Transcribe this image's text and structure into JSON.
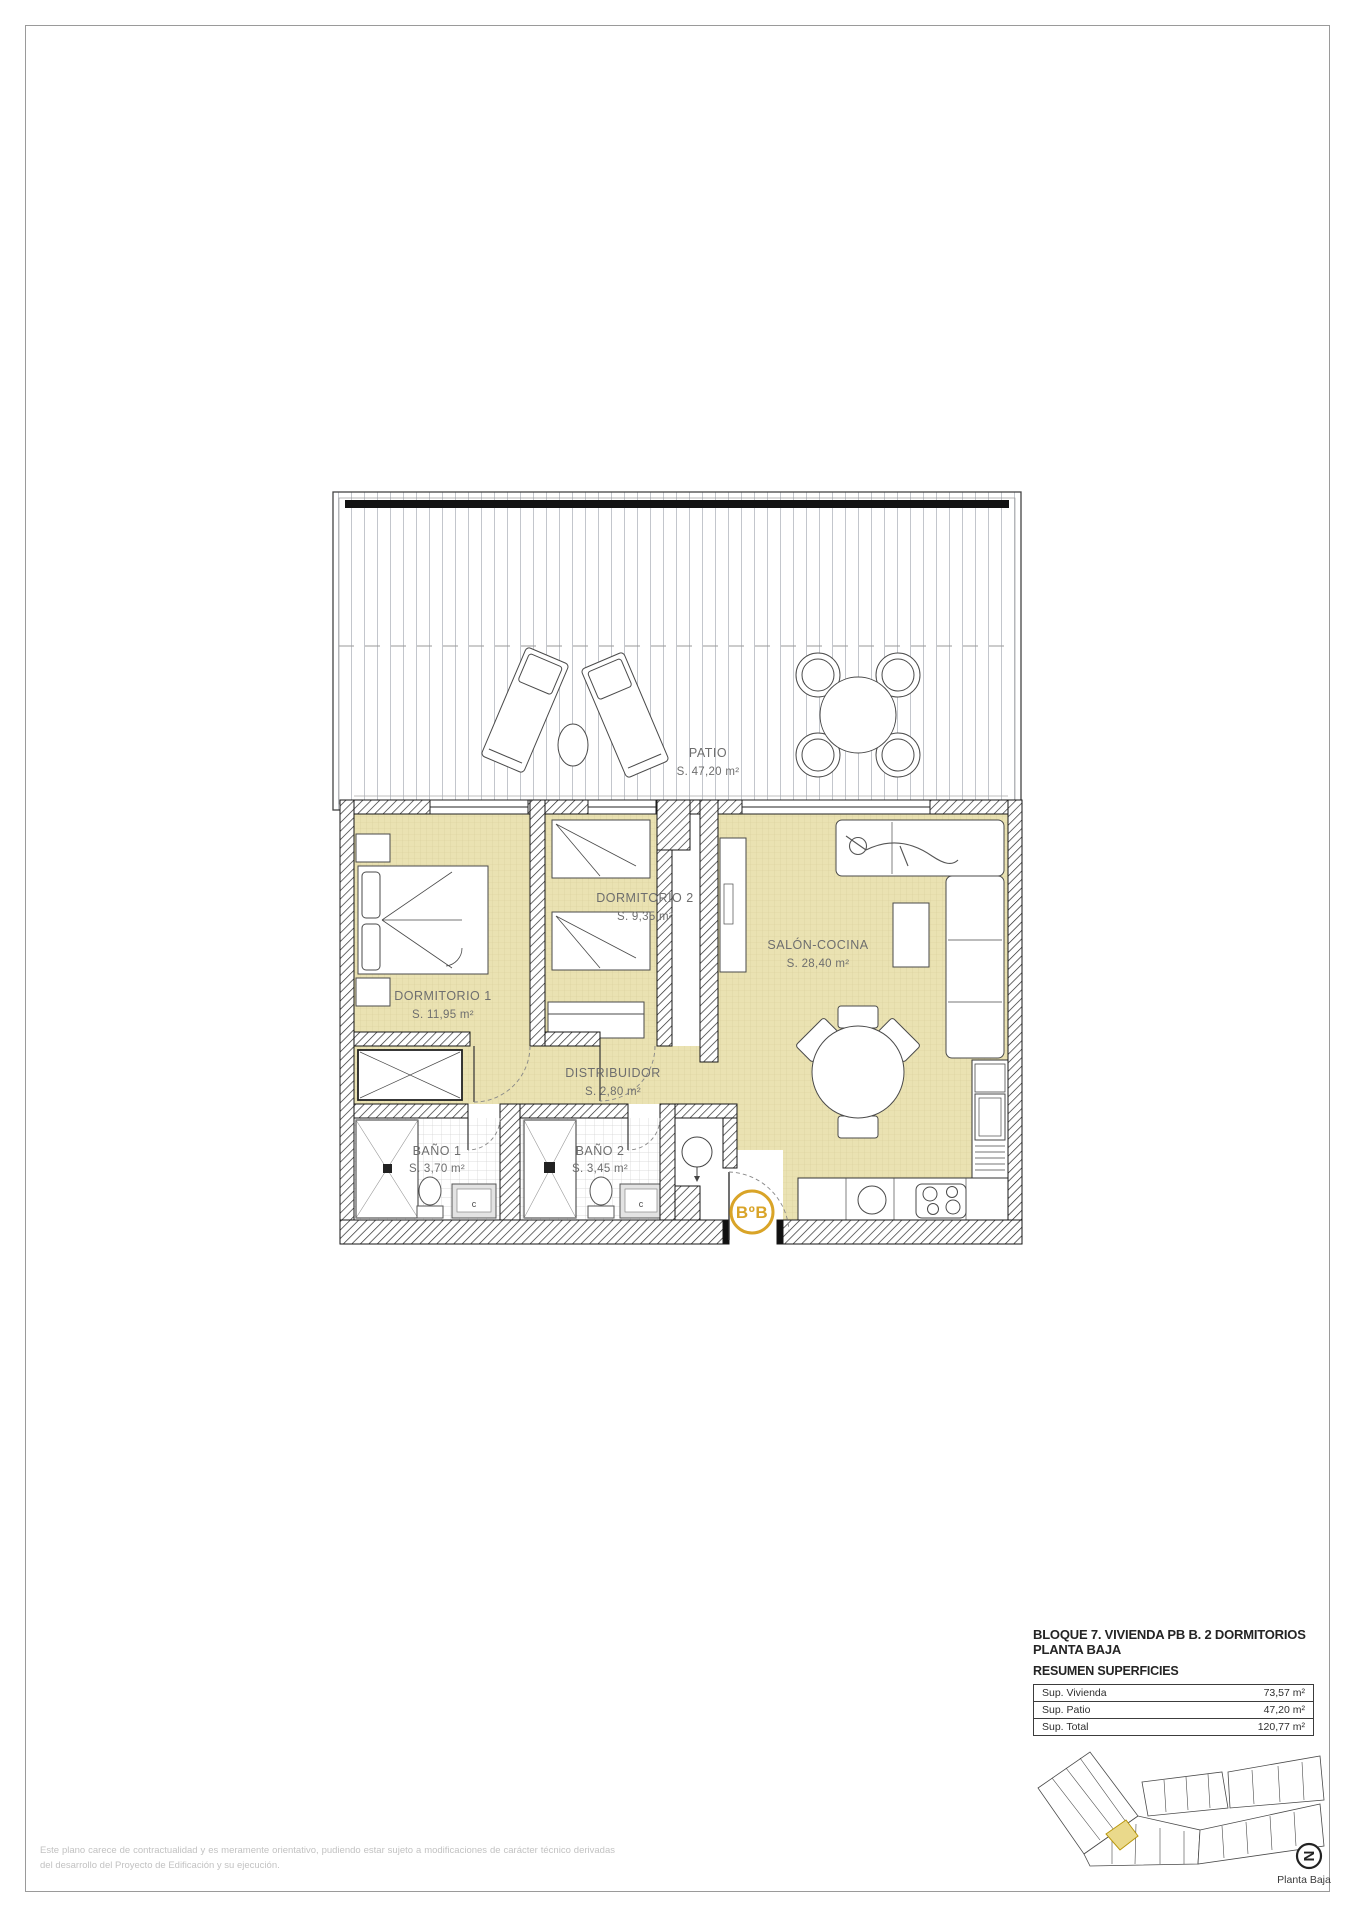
{
  "plan": {
    "patio": {
      "name": "PATIO",
      "area": "S. 47,20 m²"
    },
    "dormitorio1": {
      "name": "DORMITORIO 1",
      "area": "S. 11,95 m²"
    },
    "dormitorio2": {
      "name": "DORMITORIO 2",
      "area": "S. 9,35 m²"
    },
    "salon_cocina": {
      "name": "SALÓN-COCINA",
      "area": "S. 28,40 m²"
    },
    "distribuidor": {
      "name": "DISTRIBUIDOR",
      "area": "S. 2,80 m²"
    },
    "bano1": {
      "name": "BAÑO 1",
      "area": "S. 3,70 m²"
    },
    "bano2": {
      "name": "BAÑO 2",
      "area": "S. 3,45 m²"
    },
    "entrance_badge": "BºB",
    "vanity_label": "c",
    "colors": {
      "floor": "#eae2b2",
      "badge": "#d9a428",
      "highlight": "#ead98b"
    }
  },
  "title_block": {
    "line1": "BLOQUE 7. VIVIENDA PB B. 2 DORMITORIOS",
    "line2": "PLANTA BAJA",
    "subtitle": "RESUMEN SUPERFICIES",
    "table": {
      "rows": [
        {
          "label": "Sup. Vivienda",
          "value": "73,57 m²"
        },
        {
          "label": "Sup. Patio",
          "value": "47,20 m²"
        },
        {
          "label": "Sup. Total",
          "value": "120,77 m²"
        }
      ]
    }
  },
  "site_plan": {
    "floor_label": "Planta Baja",
    "north_glyph": "N"
  },
  "footer": {
    "disclaimer": "Este plano carece de contractualidad y es meramente orientativo, pudiendo estar sujeto a modificaciones de carácter técnico derivadas del desarrollo del Proyecto de Edificación y su ejecución."
  }
}
